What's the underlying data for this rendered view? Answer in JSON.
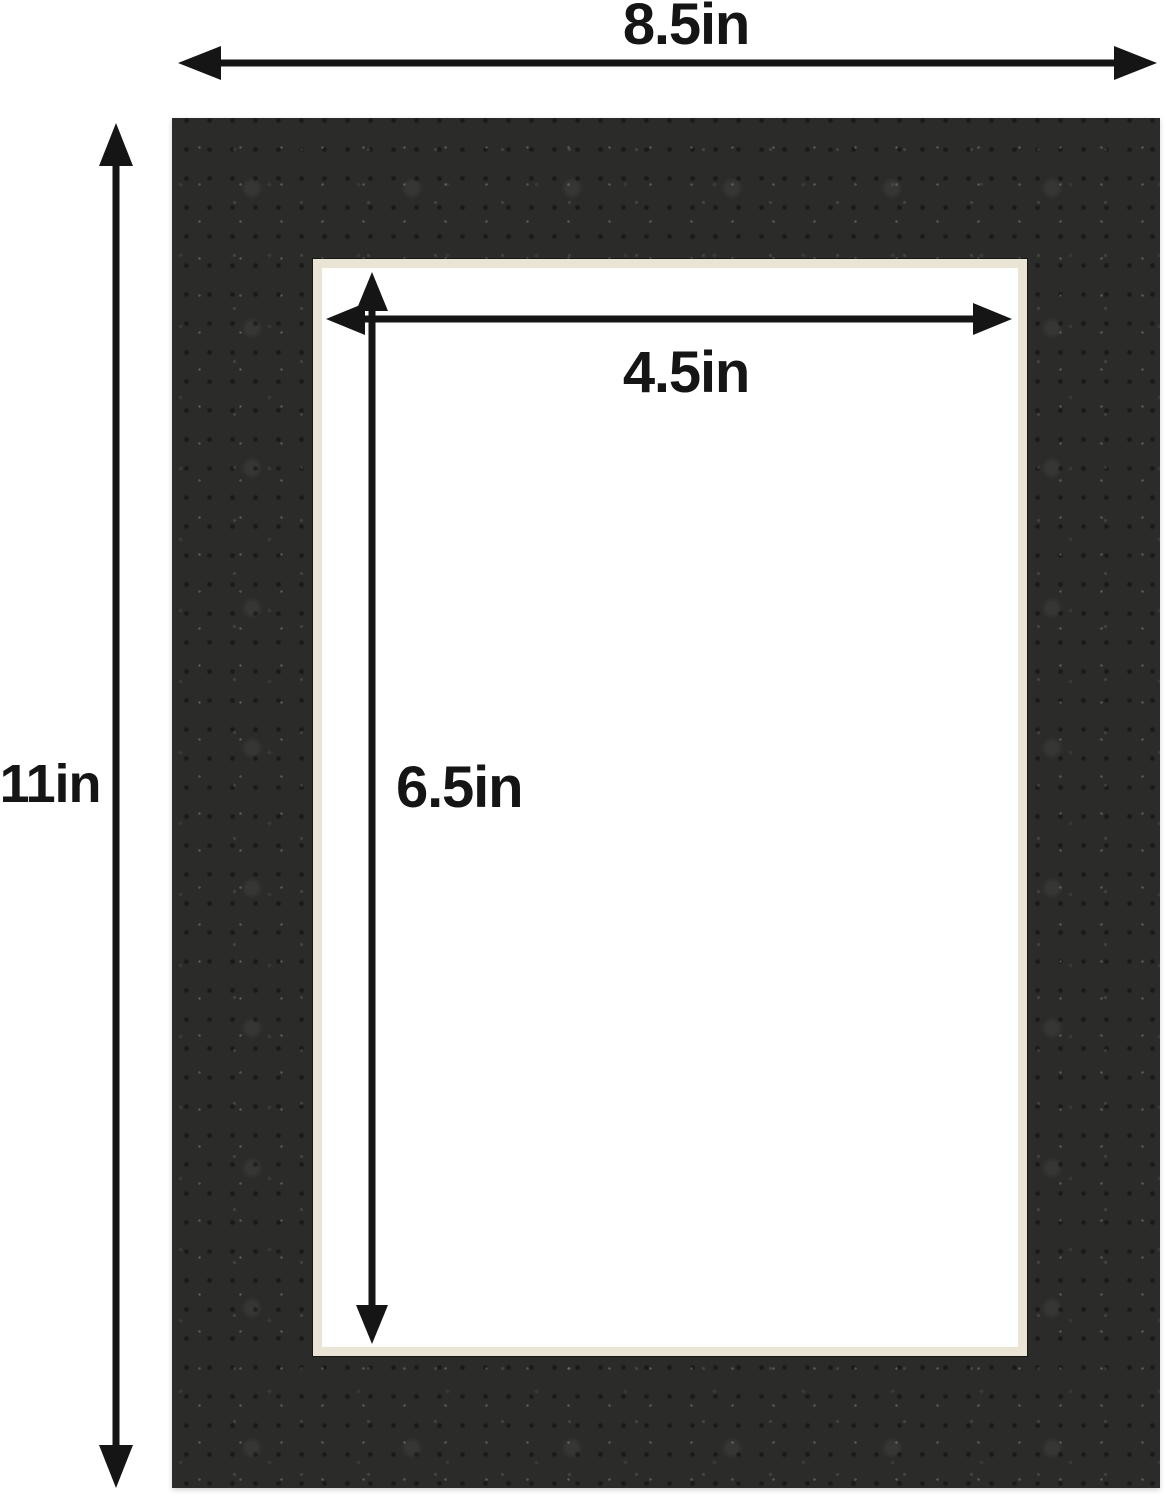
{
  "diagram": {
    "description": "Black picture-frame mat board shown with outer dimensions and opening dimensions",
    "labels": {
      "outer_width": "8.5in",
      "outer_height": "11in",
      "opening_width": "4.5in",
      "opening_height": "6.5in"
    },
    "colors": {
      "mat": "#2b2b2a",
      "bevel": "#e9e4d4",
      "opening": "#ffffff",
      "background": "#ffffff",
      "annotation": "#151515"
    }
  }
}
